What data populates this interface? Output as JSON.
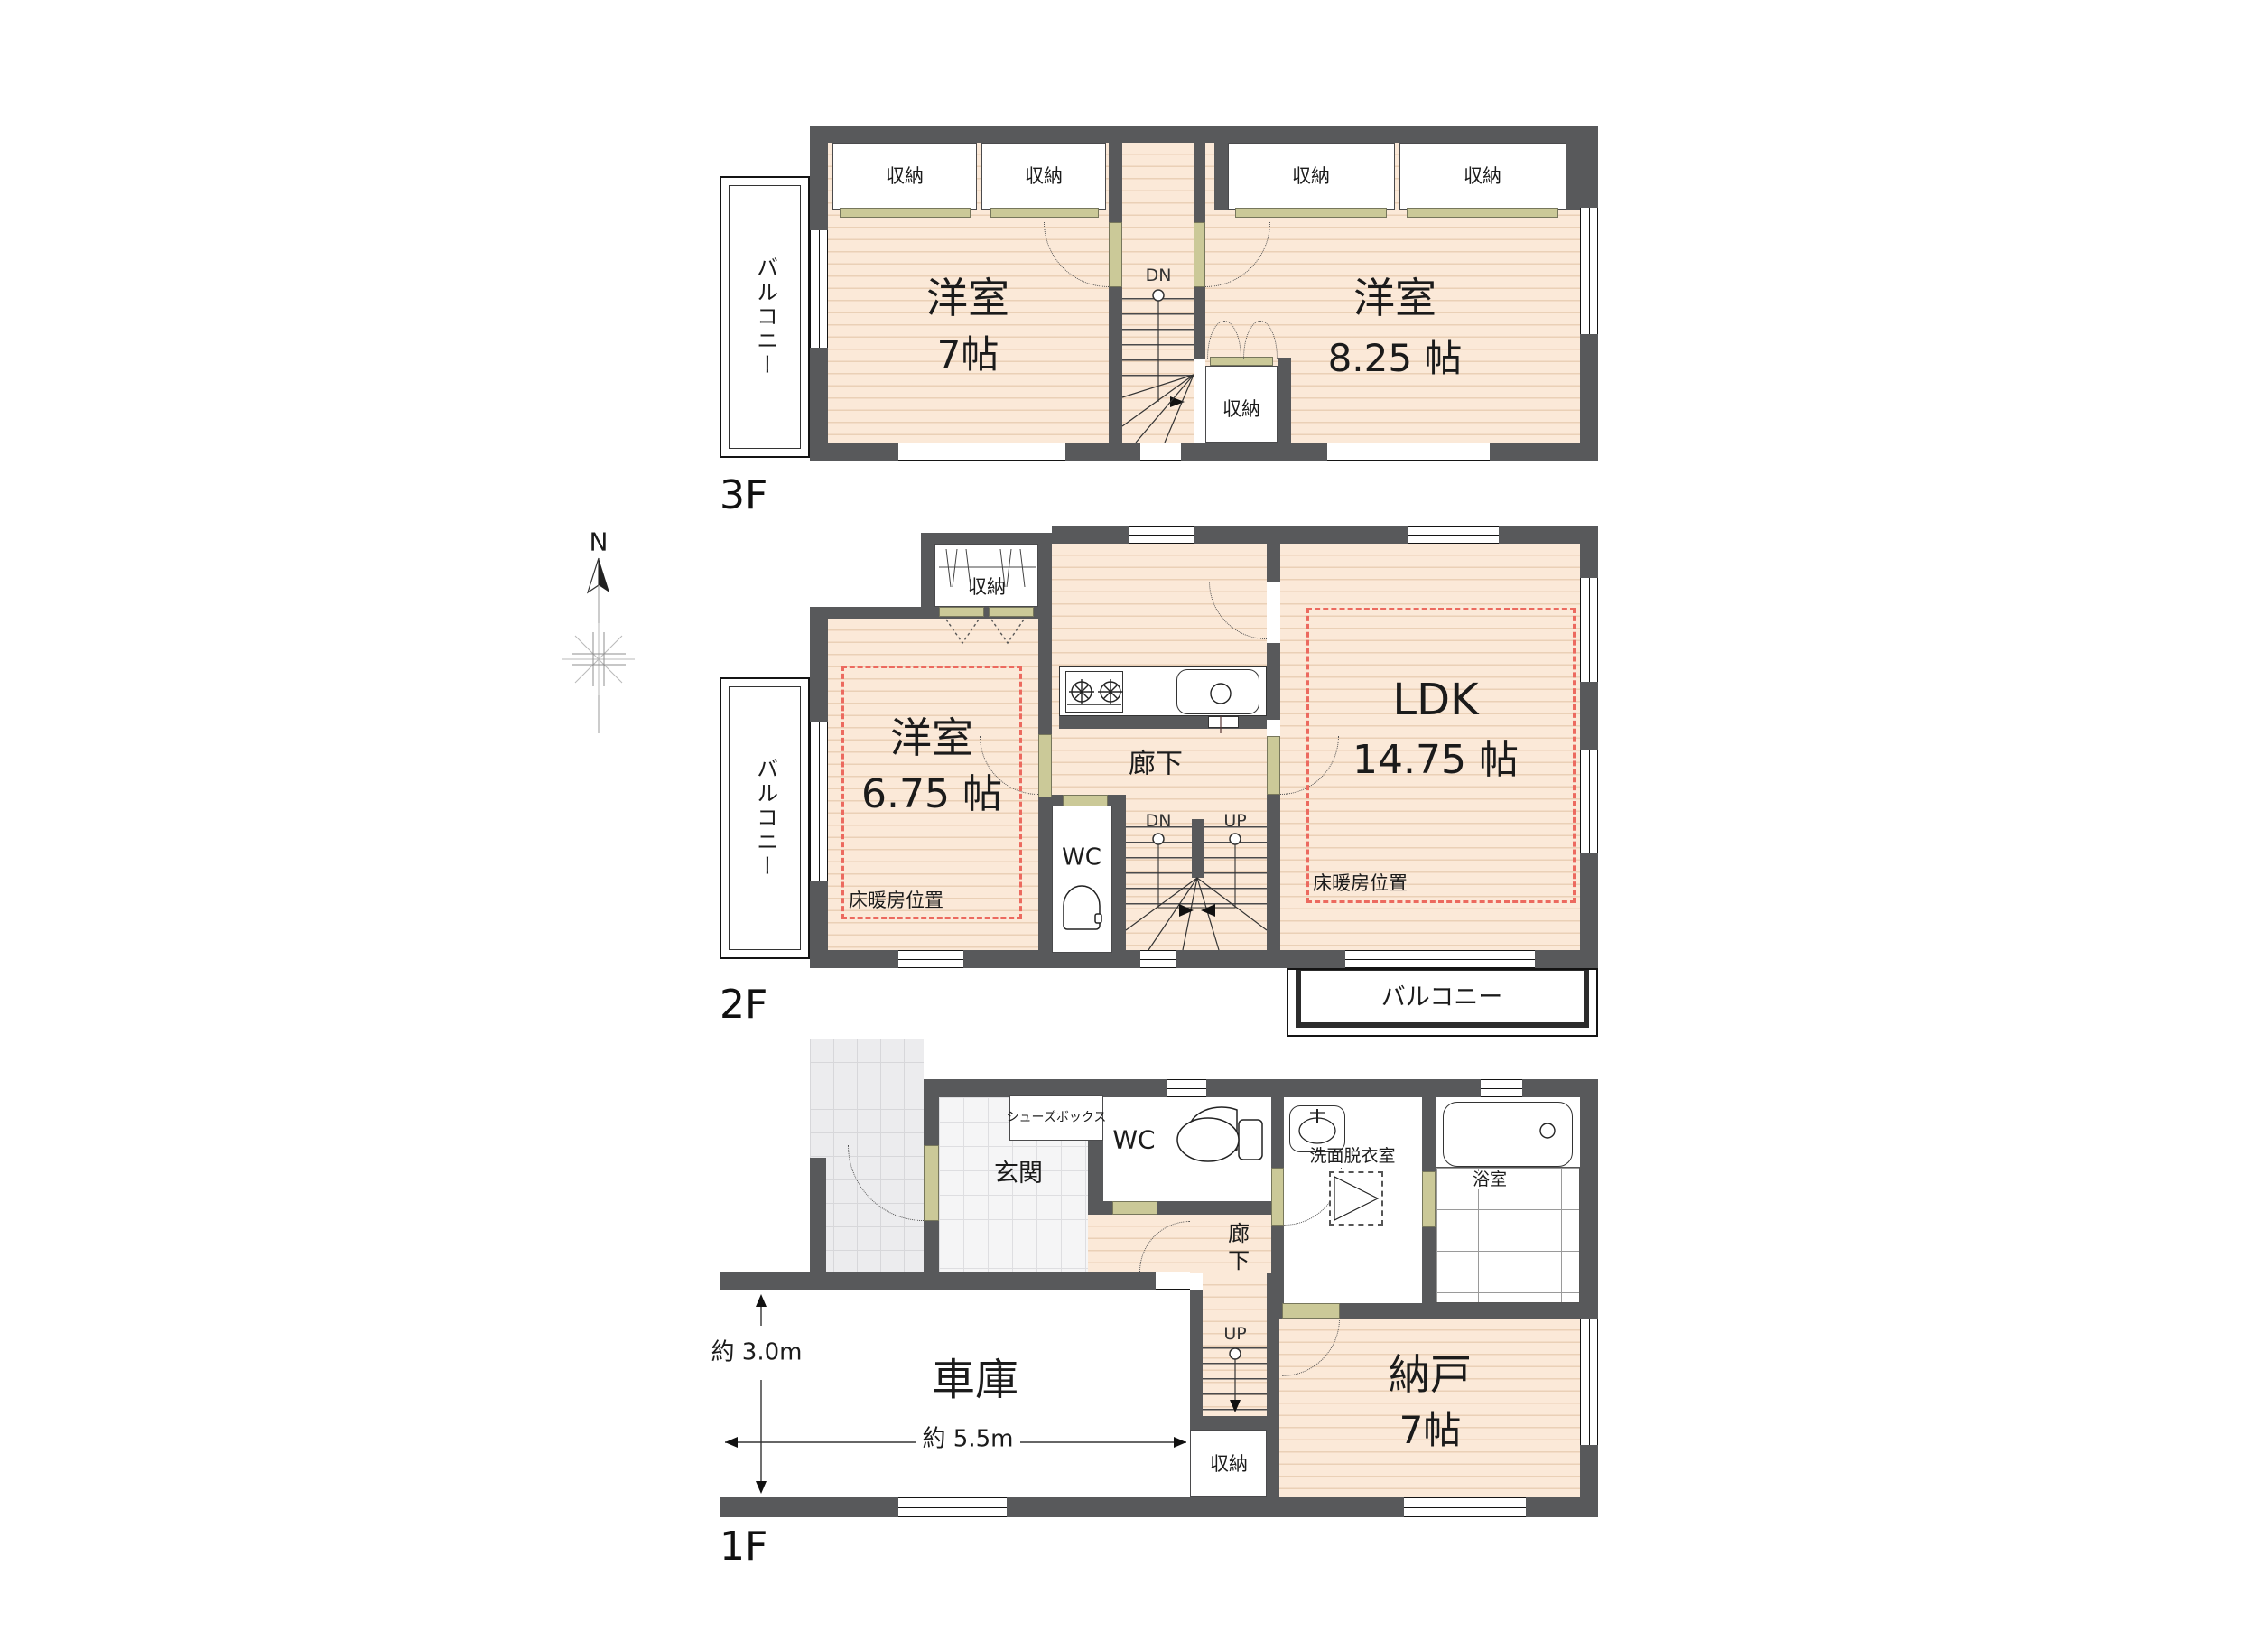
{
  "colors": {
    "wall": "#58595B",
    "floor": "#FBE9D8",
    "door_accent": "#CBC998",
    "floor_heating_dash": "#EC6A5F",
    "porch_tile": "#ECECEE"
  },
  "labels": {
    "closet": "収納",
    "balcony": "バルコニー",
    "western_room": "洋室",
    "hallway": "廊下",
    "wc": "WC",
    "down": "DN",
    "up": "UP",
    "floor_heating": "床暖房位置",
    "north": "N"
  },
  "f3": {
    "floor": "3F",
    "west_room_size": "7帖",
    "east_room_size": "8.25 帖"
  },
  "f2": {
    "floor": "2F",
    "west_room_size": "6.75 帖",
    "ldk": "LDK",
    "ldk_size": "14.75 帖"
  },
  "f1": {
    "floor": "1F",
    "shoe_box": "シューズボックス",
    "entrance": "玄関",
    "washroom": "洗面脱衣室",
    "bathroom": "浴室",
    "storage_room": "納戸",
    "storage_room_size": "7帖",
    "garage": "車庫",
    "dim_depth": "約 3.0m",
    "dim_width": "約 5.5m"
  }
}
